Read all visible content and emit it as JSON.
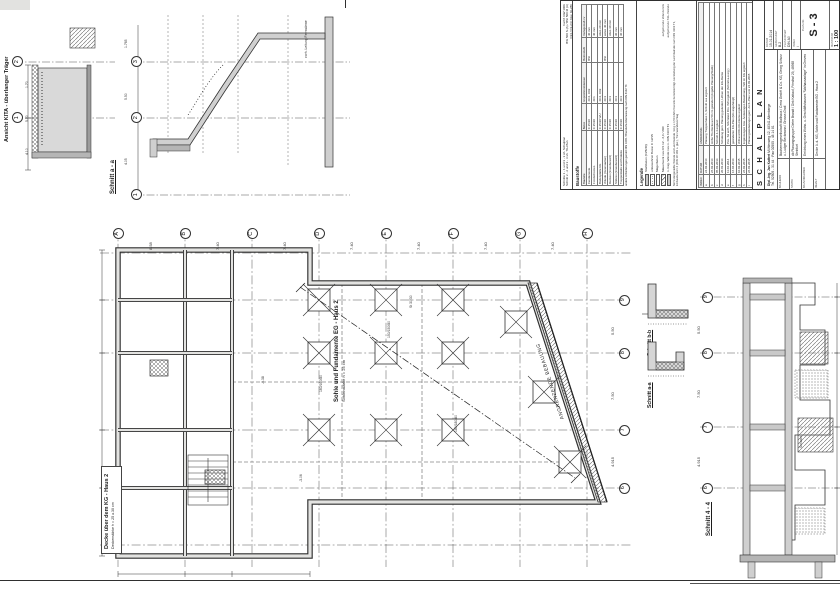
{
  "sheet": {
    "bg": "#ffffff",
    "line": "#2f2f2f",
    "wall_fill": "#c9c9c9"
  },
  "labels": {
    "kita_view": "Ansicht KITA - überlanger Träger",
    "section_aa_top": "Schnitt a - a",
    "plan_title": "Sohle und Fundamente EG - Haus 2",
    "plan_subtitle": "Sohlenstärke h = 25 cm",
    "deck_title": "Decke über dem KG - Haus 2",
    "deck_subtitle": "Deckenstärke h = 25 u.30 cm",
    "adjacent_building": "ANGRENZENDE BEBAUUNG",
    "section_bb_detail": "Schnitt b-b",
    "section_aa_detail": "Schnitt a-a",
    "section_44": "Schnitt 4 - 4",
    "shaft_note": "Schacht"
  },
  "plan": {
    "grid_top": [
      "A",
      "B",
      "C",
      "D",
      "E",
      "F",
      "G",
      "H"
    ],
    "dims_top": [
      "8.58",
      "7.40",
      "7.40",
      "7.40",
      "7.40",
      "7.40",
      "7.40"
    ],
    "grid_right": [
      "9",
      "8",
      "7",
      "6"
    ],
    "dims_right": [
      "5.50",
      "7.50",
      "4.915"
    ],
    "footings": [
      "150/150/80",
      "160/160/80",
      "180/180/80"
    ],
    "levels": [
      "-0.38",
      "-3.06"
    ],
    "column_label": "St 30/30"
  },
  "kita": {
    "axes": [
      "2",
      "1"
    ],
    "dims": [
      "1.70",
      "5.00",
      "4.10"
    ]
  },
  "section_aa": {
    "axes": [
      "3",
      "2",
      "1"
    ],
    "dims": [
      "1.765",
      "5.50",
      "4.05"
    ],
    "note": "vorh. Leitung Fernwärme"
  },
  "section44": {
    "axes": [
      "9",
      "8",
      "7",
      "6"
    ],
    "dims": [
      "5.50",
      "7.50",
      "4.915"
    ]
  },
  "titleblock": {
    "notes_top": [
      "Schnitte 1 - 1 und 3 - 3 sh. Schalplan",
      "Schnitt 2 - 2 und 3 - 3 sh. TG-Plan"
    ],
    "spec_lines": [
      "hochf. GW 100b",
      "BSt 500 S (A) / BSt 500 M (A)",
      "C24 / C2-24 t bzw. GL28h"
    ],
    "baustoffe": {
      "title": "Baustoffe",
      "headers": [
        "Bauteile",
        "Beton",
        "Expositionsklassen",
        "Betonstahl",
        "Verlegemaß cv"
      ],
      "rows": [
        [
          "Fundamente",
          "C 25/30",
          "XC4, XD2",
          "BSt",
          "40 mm"
        ],
        [
          "Frostschürzen",
          "C 25/30",
          "XF1",
          "",
          "40 mm"
        ],
        [
          "Bodenplatte KG",
          "C 25/30 WU",
          "XC4, XD2",
          "",
          "oben 20 mm"
        ],
        [
          "Wände (Innen/außen)",
          "C 25/30",
          "XC1",
          "BSt",
          "unten 40 mm"
        ],
        [
          "Decken (Innenbereich)",
          "C 25/30",
          "XC1",
          "",
          "oben 30 mm"
        ],
        [
          "Stützen (Innenbereich)",
          "C 25/30",
          "XC1",
          "",
          "30 mm"
        ],
        [
          "Treppenläufe und Podeste",
          "C 25/30",
          "XC1",
          "",
          "30 mm"
        ]
      ],
      "footnote": "andere Anforderungen gemäß DIN 1045 / Brandschutzbemessung nach DIN 4102 T4"
    },
    "legende": {
      "title": "Legende",
      "items": [
        {
          "swatch": "solid",
          "label": "Stahlbeton (C25/30)",
          "note": ""
        },
        {
          "swatch": "dots",
          "label": "unbewehrter Beton C 12/15",
          "note": ""
        },
        {
          "swatch": "plain",
          "label": "Magerbeton",
          "note": ""
        },
        {
          "swatch": "hatch",
          "label": "Mauerwerk neu KS 12 - 2,0 / 2DF",
          "note": "aufgehende Wände EG"
        },
        {
          "swatch": "dots2",
          "label": "n. trag. Wände neu n. DIN 4103 T1",
          "note": "aufgehende Stb.-Wände"
        }
      ],
      "note": "Nicht dargestellte Wände und Leichtwände mit g ≤ 1,50 kN/m² bereits berücksichtigt. Herstellung der Leichtwände nach DIN 4103 T1, Einbaubereich 2 (DIN 18 183 o. glw.), Trennwandzuschlag"
    },
    "revisions": {
      "headers": [
        "INDEX",
        "DATUM",
        "ÄNDERUNG"
      ],
      "rows": [
        [
          "a",
          "24.02.2014",
          "Planung Treppenhaus 1, Schnitt a-a ergänzt"
        ],
        [
          "b",
          "26.02.2014",
          "Höhe TG-Decke um 50 cm geändert (Angabe Planung/Statik)"
        ],
        [
          "c",
          "05.03.2014",
          "Schnitt 4-4 ergänzt"
        ],
        [
          "d",
          "20.03.2014",
          "Schalung gem. Planung geändert, Höhen der EG-Decke"
        ],
        [
          "e",
          "11.04.2014",
          "Pos. S2 entf., Stb-Wand Pos. W8 ergänzt (Schnitt a-a erg.)"
        ],
        [
          "f",
          "16.04.2014",
          "geänderter KG-Plan (EG angehängt)"
        ],
        [
          "g",
          "10.02.2015",
          "WD und DG KG-Decke ergänzt"
        ],
        [
          "h",
          "26.02.2015",
          "Ergänzungen bzw. Änderungen Bewehrung, WD im KG ergänzt"
        ],
        [
          "i",
          "26.03.2015",
          "Planungsänderungen gem. Arch.-Plan vom 24.03.2015"
        ]
      ]
    },
    "plan_type": "S C H A L P L A N",
    "engineer": {
      "name": "Dipl.-Ing. Jan Kattert",
      "street": "Mühlenweg 12",
      "city": "48341 Altenberge",
      "tel": "Tel.  02505 - 31 44",
      "fax": "Fax  02505 - 48 14 81"
    },
    "fields": [
      {
        "label": "Bauherr",
        "value": "Bauherrengesellschaft Mallhaus / Cerra GmbH & Co. KG, Georg Schurz u. Ludger Beckmann / Grosse-Gratl"
      },
      {
        "label": "Statik",
        "value": "db Planungsgruppe Dieter Brandt / Dirk Kattauf, Friedhof 29, 48565 Steinfurt"
      },
      {
        "label": "Bauvorhaben",
        "value": "Errichtung eines Wohn- u. Geschäftshauses \"Walhausanlage\" in Greven"
      },
      {
        "label": "Inhalt",
        "value": "Decke ü. d. KG, Sohle und Fundamente EG - Haus 2"
      }
    ],
    "meta": [
      {
        "label": "Datum",
        "value": "15.01.2014"
      },
      {
        "label": "gezeichnet",
        "value": "B.2"
      },
      {
        "label": "Planformat",
        "value": "DIN A0"
      },
      {
        "label": "Index",
        "value": "i"
      }
    ],
    "plan_nr_label": "Plan-Nr.",
    "plan_nr": "S - 3",
    "scale_label": "Maßstab",
    "scale": "1 : 100"
  }
}
